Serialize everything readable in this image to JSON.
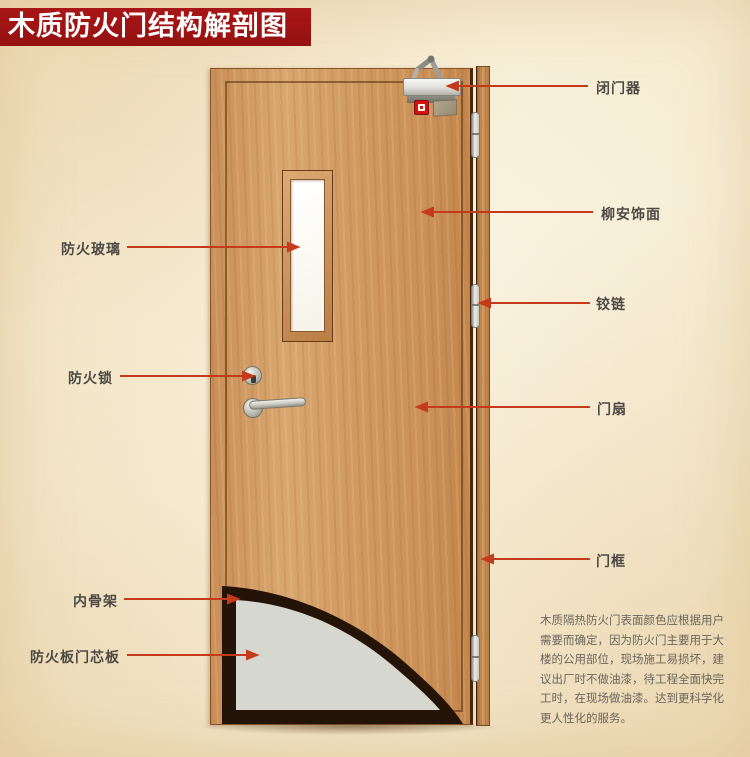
{
  "title": "木质防火门结构解剖图",
  "labels": {
    "fire_glass": "防火玻璃",
    "fire_lock": "防火锁",
    "inner_frame": "内骨架",
    "fire_board_core": "防火板门芯板",
    "door_closer": "闭门器",
    "lauan_veneer": "柳安饰面",
    "hinge": "铰链",
    "door_leaf": "门扇",
    "door_frame": "门框"
  },
  "description": {
    "lines": [
      "木质隔热防火门表面颜色应根据用户",
      "需要而确定，因为防火门主要用于大",
      "楼的公用部位，现场施工易损坏，建",
      "议出厂时不做油漆，待工程全面快完",
      "工时，在现场做油漆。达到更科学化",
      "更人性化的服务。"
    ]
  },
  "colors": {
    "banner_red": "#9b1313",
    "leader_line_red": "#c63a1c",
    "label_text": "#4d4a45",
    "door_wood": "#d09a63",
    "frame_wood": "#b67c42",
    "core_gray": "#d6d8d0",
    "cutaway_dark": "#241307",
    "background_cream": "#f6ecd2",
    "glass_white": "#faf8ee"
  }
}
